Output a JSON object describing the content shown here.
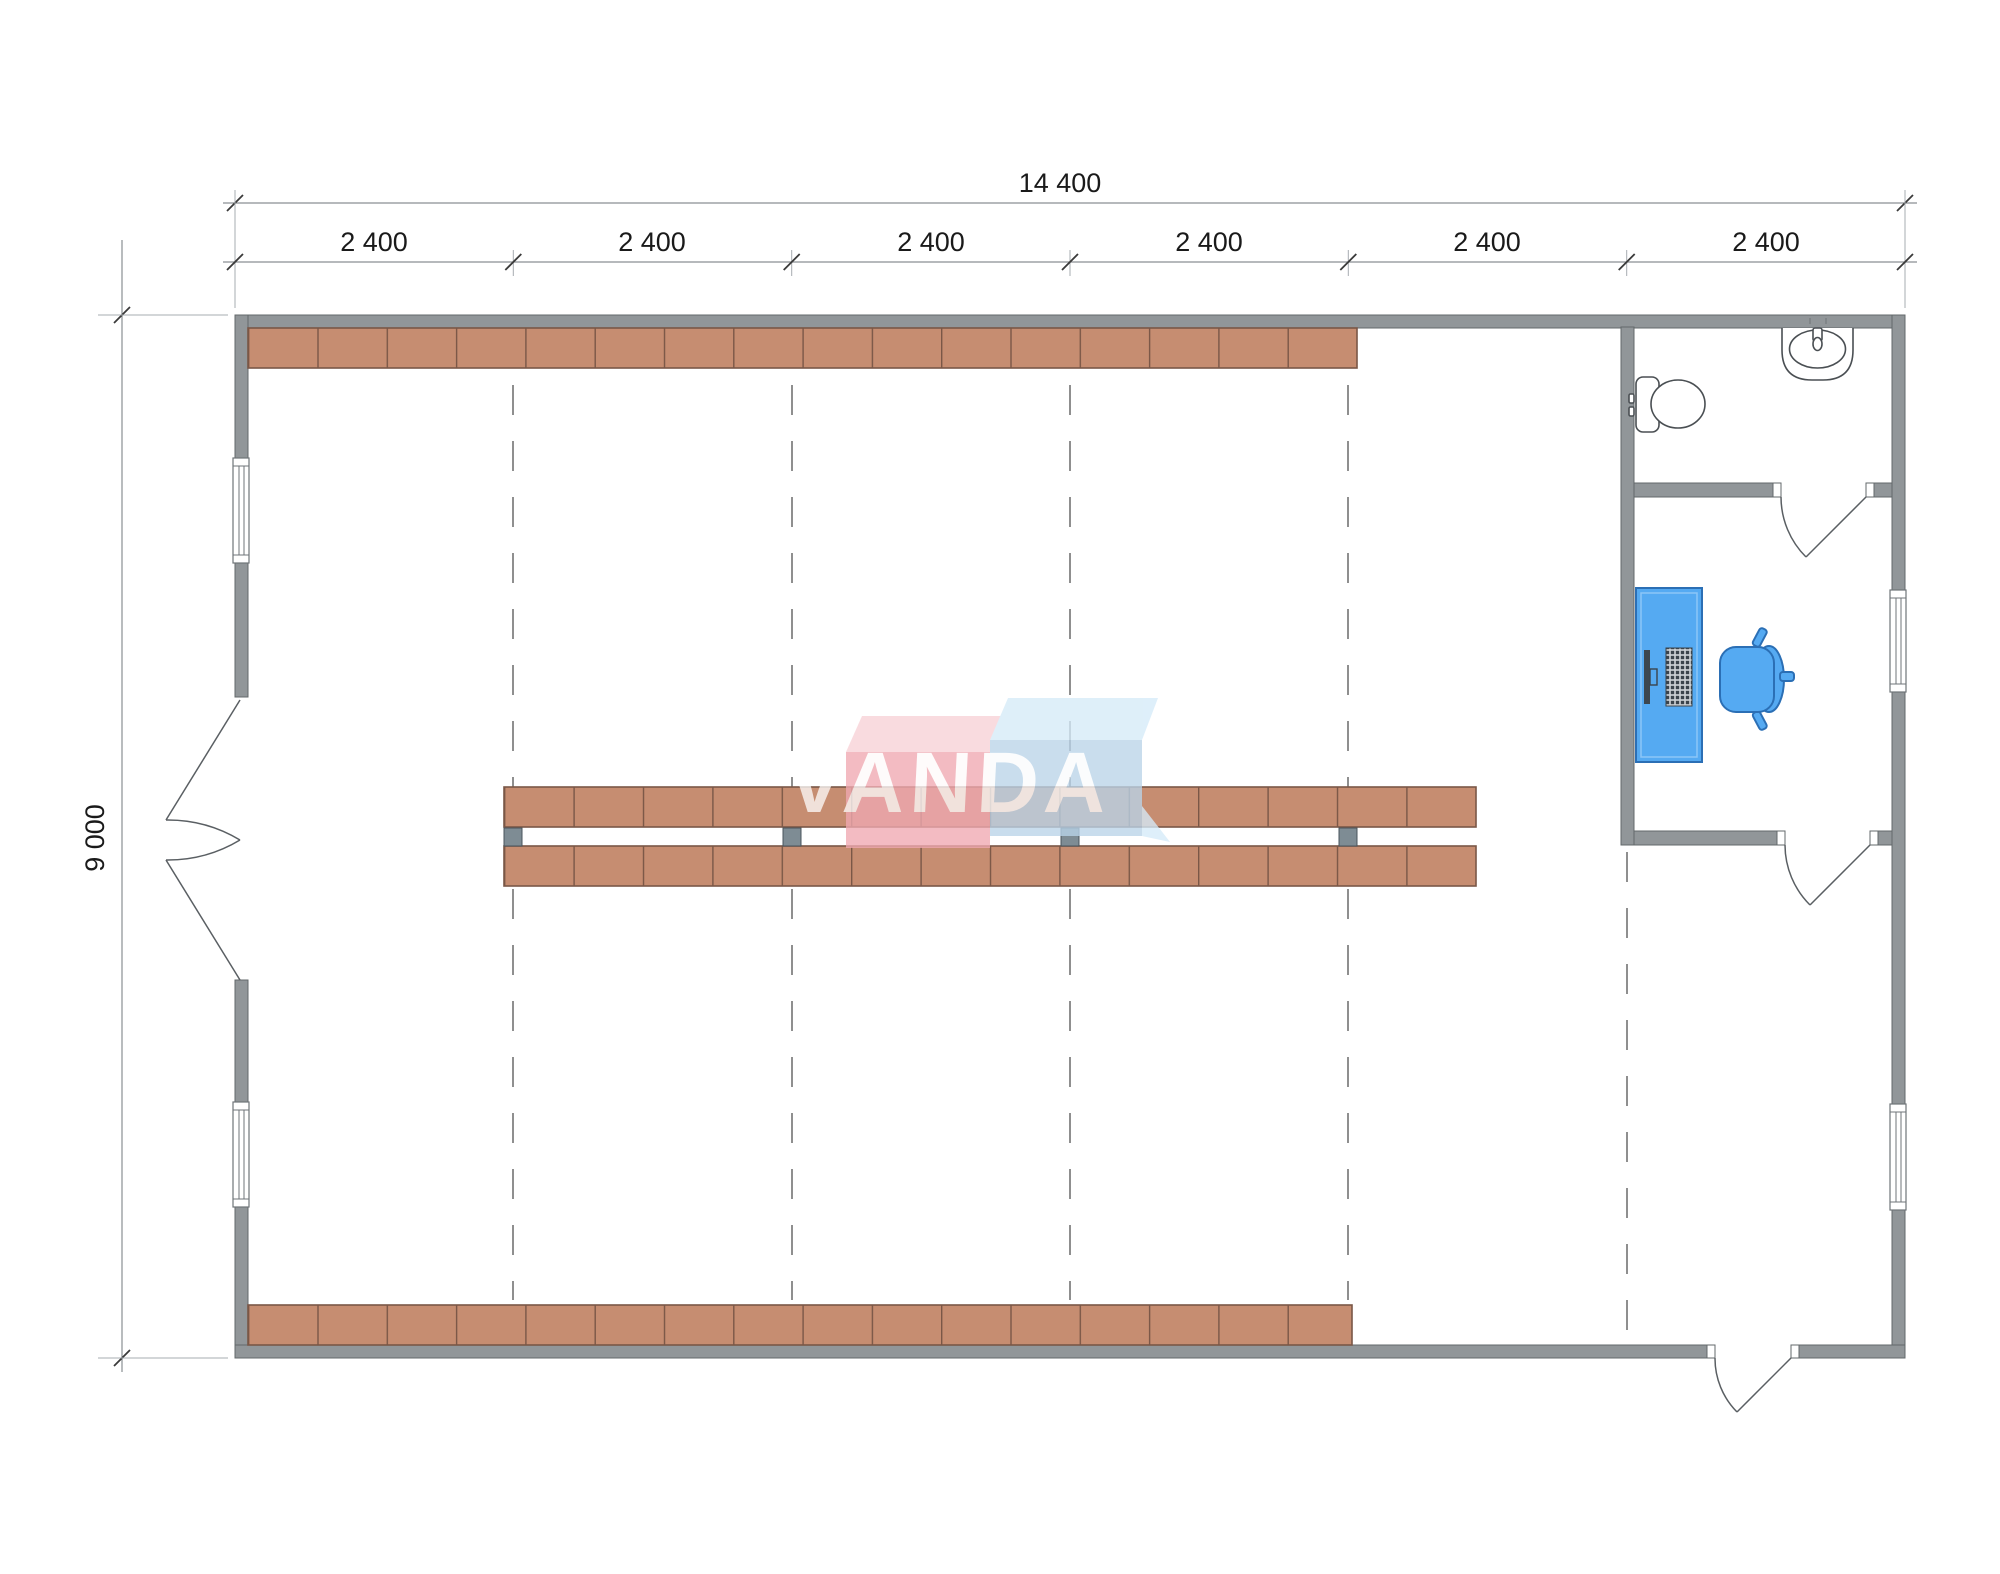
{
  "dimensions": {
    "total_width": "14 400",
    "bays": [
      "2 400",
      "2 400",
      "2 400",
      "2 400",
      "2 400",
      "2 400"
    ],
    "total_height": "9 000"
  },
  "watermark": {
    "text": "VANDA"
  },
  "colors": {
    "wall": "#919699",
    "wall_edge": "#63686b",
    "shelf": "#c68d71",
    "shelf_edge": "#7a5747",
    "post": "#7e8c94",
    "furniture": "#55aaf2",
    "furniture_edge": "#2b6fb5",
    "grid_dash": "#8f8f8f",
    "dim_text": "#1a1a1a",
    "wm_pink": "#f0a9b1",
    "wm_pink_top": "#f8d1d7",
    "wm_blue": "#bad4e9",
    "wm_blue_top": "#d5ebf8",
    "wm_text": "#ffffff"
  }
}
